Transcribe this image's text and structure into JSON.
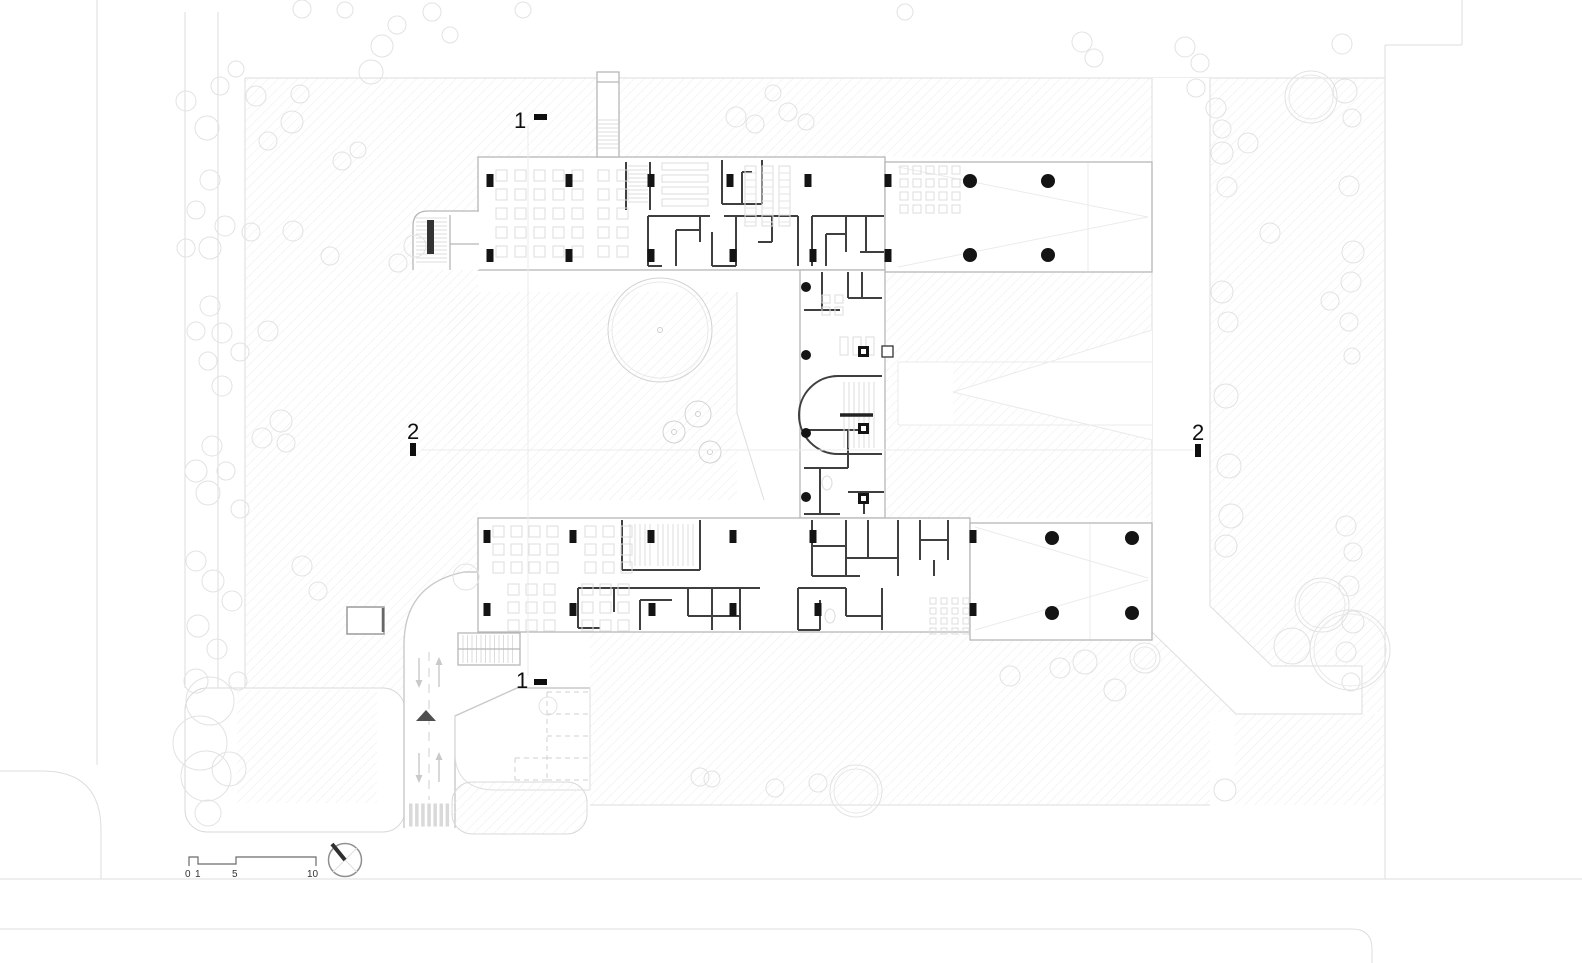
{
  "drawing": {
    "title": "Ground floor site plan",
    "section_markers": [
      {
        "label": "1",
        "position": "top"
      },
      {
        "label": "1",
        "position": "bottom"
      },
      {
        "label": "2",
        "position": "left"
      },
      {
        "label": "2",
        "position": "right"
      }
    ],
    "scale_bar": {
      "labels": [
        "0",
        "1",
        "5",
        "10"
      ]
    },
    "colors": {
      "background": "#ffffff",
      "hatch": "#ececec",
      "tree": "#e2e2e2",
      "road": "#c9c9c9",
      "wall_dark": "#3f3f3f",
      "wall_light": "#b7b7b7",
      "column": "#141414",
      "furniture": "#dcdcdc",
      "marker": "#0e0e0e"
    },
    "trees": [
      [
        207,
        128,
        12
      ],
      [
        186,
        101,
        10
      ],
      [
        220,
        86,
        9
      ],
      [
        236,
        69,
        8
      ],
      [
        256,
        96,
        10
      ],
      [
        292,
        122,
        11
      ],
      [
        300,
        94,
        9
      ],
      [
        268,
        141,
        9
      ],
      [
        210,
        180,
        10
      ],
      [
        196,
        210,
        9
      ],
      [
        225,
        226,
        10
      ],
      [
        210,
        248,
        11
      ],
      [
        251,
        232,
        9
      ],
      [
        186,
        248,
        9
      ],
      [
        293,
        231,
        10
      ],
      [
        330,
        256,
        9
      ],
      [
        210,
        306,
        10
      ],
      [
        196,
        331,
        9
      ],
      [
        222,
        333,
        10
      ],
      [
        268,
        331,
        10
      ],
      [
        240,
        352,
        9
      ],
      [
        208,
        361,
        9
      ],
      [
        222,
        386,
        10
      ],
      [
        281,
        421,
        11
      ],
      [
        262,
        438,
        10
      ],
      [
        286,
        443,
        9
      ],
      [
        212,
        446,
        10
      ],
      [
        196,
        471,
        11
      ],
      [
        226,
        471,
        9
      ],
      [
        208,
        493,
        12
      ],
      [
        240,
        509,
        9
      ],
      [
        196,
        561,
        10
      ],
      [
        213,
        581,
        11
      ],
      [
        232,
        601,
        10
      ],
      [
        198,
        626,
        11
      ],
      [
        217,
        649,
        10
      ],
      [
        196,
        681,
        12
      ],
      [
        238,
        681,
        9
      ],
      [
        302,
        566,
        10
      ],
      [
        318,
        591,
        9
      ],
      [
        210,
        701,
        24
      ],
      [
        200,
        743,
        27
      ],
      [
        229,
        769,
        17
      ],
      [
        206,
        776,
        25
      ],
      [
        208,
        813,
        13
      ],
      [
        382,
        46,
        11
      ],
      [
        371,
        72,
        12
      ],
      [
        397,
        25,
        9
      ],
      [
        342,
        161,
        9
      ],
      [
        358,
        150,
        8
      ],
      [
        415,
        246,
        11
      ],
      [
        398,
        263,
        9
      ],
      [
        345,
        10,
        8
      ],
      [
        302,
        9,
        9
      ],
      [
        432,
        12,
        9
      ],
      [
        450,
        35,
        8
      ],
      [
        523,
        10,
        8
      ],
      [
        736,
        117,
        10
      ],
      [
        755,
        124,
        9
      ],
      [
        788,
        112,
        9
      ],
      [
        806,
        122,
        8
      ],
      [
        773,
        93,
        8
      ],
      [
        905,
        12,
        8
      ],
      [
        1082,
        42,
        10
      ],
      [
        1094,
        58,
        9
      ],
      [
        1185,
        47,
        10
      ],
      [
        1200,
        63,
        9
      ],
      [
        1196,
        88,
        9
      ],
      [
        1216,
        108,
        10
      ],
      [
        1222,
        129,
        9
      ],
      [
        1248,
        143,
        10
      ],
      [
        1311,
        97,
        26,
        1
      ],
      [
        1345,
        91,
        12
      ],
      [
        1342,
        44,
        10
      ],
      [
        1270,
        233,
        10
      ],
      [
        1222,
        153,
        11
      ],
      [
        1227,
        187,
        10
      ],
      [
        1222,
        292,
        11
      ],
      [
        1228,
        322,
        10
      ],
      [
        1226,
        396,
        12
      ],
      [
        1229,
        466,
        12
      ],
      [
        1231,
        516,
        12
      ],
      [
        1226,
        546,
        11
      ],
      [
        1352,
        118,
        9
      ],
      [
        1349,
        186,
        10
      ],
      [
        1353,
        252,
        11
      ],
      [
        1351,
        282,
        10
      ],
      [
        1349,
        322,
        9
      ],
      [
        1352,
        356,
        8
      ],
      [
        1346,
        526,
        10
      ],
      [
        1353,
        552,
        9
      ],
      [
        1349,
        586,
        10
      ],
      [
        1353,
        622,
        11
      ],
      [
        1346,
        652,
        10
      ],
      [
        1351,
        682,
        9
      ],
      [
        1330,
        301,
        9
      ],
      [
        1322,
        605,
        27,
        1
      ],
      [
        1350,
        650,
        40,
        1
      ],
      [
        1292,
        646,
        18
      ],
      [
        548,
        706,
        9
      ],
      [
        700,
        777,
        9
      ],
      [
        712,
        779,
        8
      ],
      [
        775,
        788,
        9
      ],
      [
        818,
        783,
        9
      ],
      [
        856,
        791,
        26,
        1
      ],
      [
        1010,
        676,
        10
      ],
      [
        1060,
        668,
        10
      ],
      [
        1085,
        662,
        12
      ],
      [
        1115,
        690,
        11
      ],
      [
        1145,
        658,
        15,
        1
      ],
      [
        1225,
        790,
        11
      ],
      [
        466,
        577,
        13
      ],
      [
        660,
        330,
        52,
        3
      ],
      [
        698,
        414,
        13,
        2
      ],
      [
        674,
        432,
        11,
        2
      ],
      [
        710,
        452,
        11,
        2
      ]
    ],
    "columns": {
      "round": [
        [
          806,
          287,
          5
        ],
        [
          806,
          355,
          5
        ],
        [
          806,
          433,
          5
        ],
        [
          806,
          497,
          5
        ],
        [
          970,
          181,
          7
        ],
        [
          1048,
          181,
          7
        ],
        [
          970,
          255,
          7
        ],
        [
          1048,
          255,
          7
        ],
        [
          1052,
          538,
          7
        ],
        [
          1132,
          538,
          7
        ],
        [
          1052,
          613,
          7
        ],
        [
          1132,
          613,
          7
        ]
      ],
      "wall": [
        [
          490,
          174
        ],
        [
          569,
          174
        ],
        [
          651,
          174
        ],
        [
          730,
          174
        ],
        [
          808,
          174
        ],
        [
          888,
          174
        ],
        [
          490,
          249
        ],
        [
          569,
          249
        ],
        [
          651,
          249
        ],
        [
          733,
          249
        ],
        [
          813,
          249
        ],
        [
          888,
          249
        ],
        [
          487,
          530
        ],
        [
          573,
          530
        ],
        [
          651,
          530
        ],
        [
          733,
          530
        ],
        [
          813,
          530
        ],
        [
          973,
          530
        ],
        [
          487,
          603
        ],
        [
          573,
          603
        ],
        [
          652,
          603
        ],
        [
          733,
          603
        ],
        [
          818,
          603
        ],
        [
          973,
          603
        ]
      ],
      "squares": [
        [
          858,
          346
        ],
        [
          858,
          423
        ],
        [
          858,
          493
        ]
      ],
      "open_squares": [
        [
          882,
          346
        ]
      ]
    },
    "furniture": {
      "grids": [
        {
          "x": 496,
          "y": 170,
          "cols": 5,
          "rows": 5,
          "w": 11,
          "h": 11,
          "sx": 19,
          "sy": 19
        },
        {
          "x": 598,
          "y": 170,
          "cols": 2,
          "rows": 5,
          "w": 11,
          "h": 11,
          "sx": 19,
          "sy": 19
        },
        {
          "x": 900,
          "y": 166,
          "cols": 5,
          "rows": 4,
          "w": 8,
          "h": 8,
          "sx": 13,
          "sy": 13
        },
        {
          "x": 493,
          "y": 526,
          "cols": 4,
          "rows": 3,
          "w": 11,
          "h": 11,
          "sx": 18,
          "sy": 18
        },
        {
          "x": 585,
          "y": 526,
          "cols": 3,
          "rows": 3,
          "w": 11,
          "h": 11,
          "sx": 18,
          "sy": 18
        },
        {
          "x": 508,
          "y": 584,
          "cols": 3,
          "rows": 3,
          "w": 11,
          "h": 11,
          "sx": 18,
          "sy": 18
        },
        {
          "x": 582,
          "y": 584,
          "cols": 3,
          "rows": 3,
          "w": 11,
          "h": 11,
          "sx": 18,
          "sy": 18
        },
        {
          "x": 930,
          "y": 598,
          "cols": 4,
          "rows": 4,
          "w": 6,
          "h": 6,
          "sx": 11,
          "sy": 10
        },
        {
          "x": 840,
          "y": 337,
          "cols": 3,
          "rows": 1,
          "w": 8,
          "h": 18,
          "sx": 13
        },
        {
          "x": 822,
          "y": 295,
          "cols": 2,
          "rows": 2,
          "w": 8,
          "h": 8,
          "sx": 13,
          "sy": 12
        }
      ],
      "tables": [
        {
          "x": 662,
          "y": 163,
          "rows": 4,
          "w": 46,
          "h": 7,
          "sy": 12
        }
      ],
      "shelves": [
        {
          "x": 745,
          "y": 166,
          "cols": 3,
          "w": 11,
          "h": 60,
          "sx": 17
        }
      ],
      "ellipses": [
        [
          827,
          483,
          5,
          7
        ],
        [
          830,
          616,
          5,
          7
        ],
        [
          137,
          0,
          0,
          0
        ]
      ]
    }
  }
}
